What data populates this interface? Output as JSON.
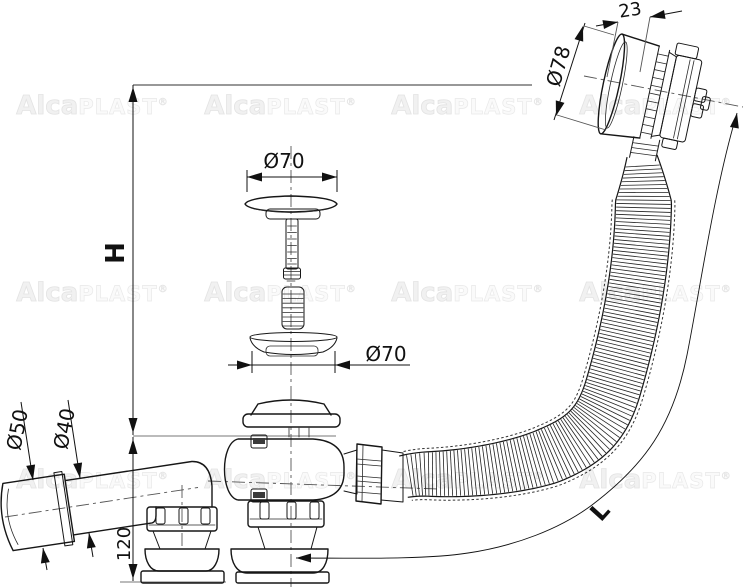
{
  "drawing": {
    "dimensions": {
      "knob_depth": "23",
      "knob_diameter": "Ø78",
      "plug_diameter": "Ø70",
      "gasket_diameter": "Ø70",
      "outlet_sleeve_diameter": "Ø50",
      "outlet_pipe_diameter": "Ø40",
      "body_height": "120",
      "installation_height": "H",
      "hose_length": "L"
    },
    "watermark": {
      "brand_bold": "Alca",
      "brand_light": "PLAST",
      "registered": "®"
    },
    "colors": {
      "line": "#161616",
      "construction": "#777777",
      "centerline": "#555555",
      "watermark": "#e8e8e8",
      "background": "#ffffff"
    }
  }
}
